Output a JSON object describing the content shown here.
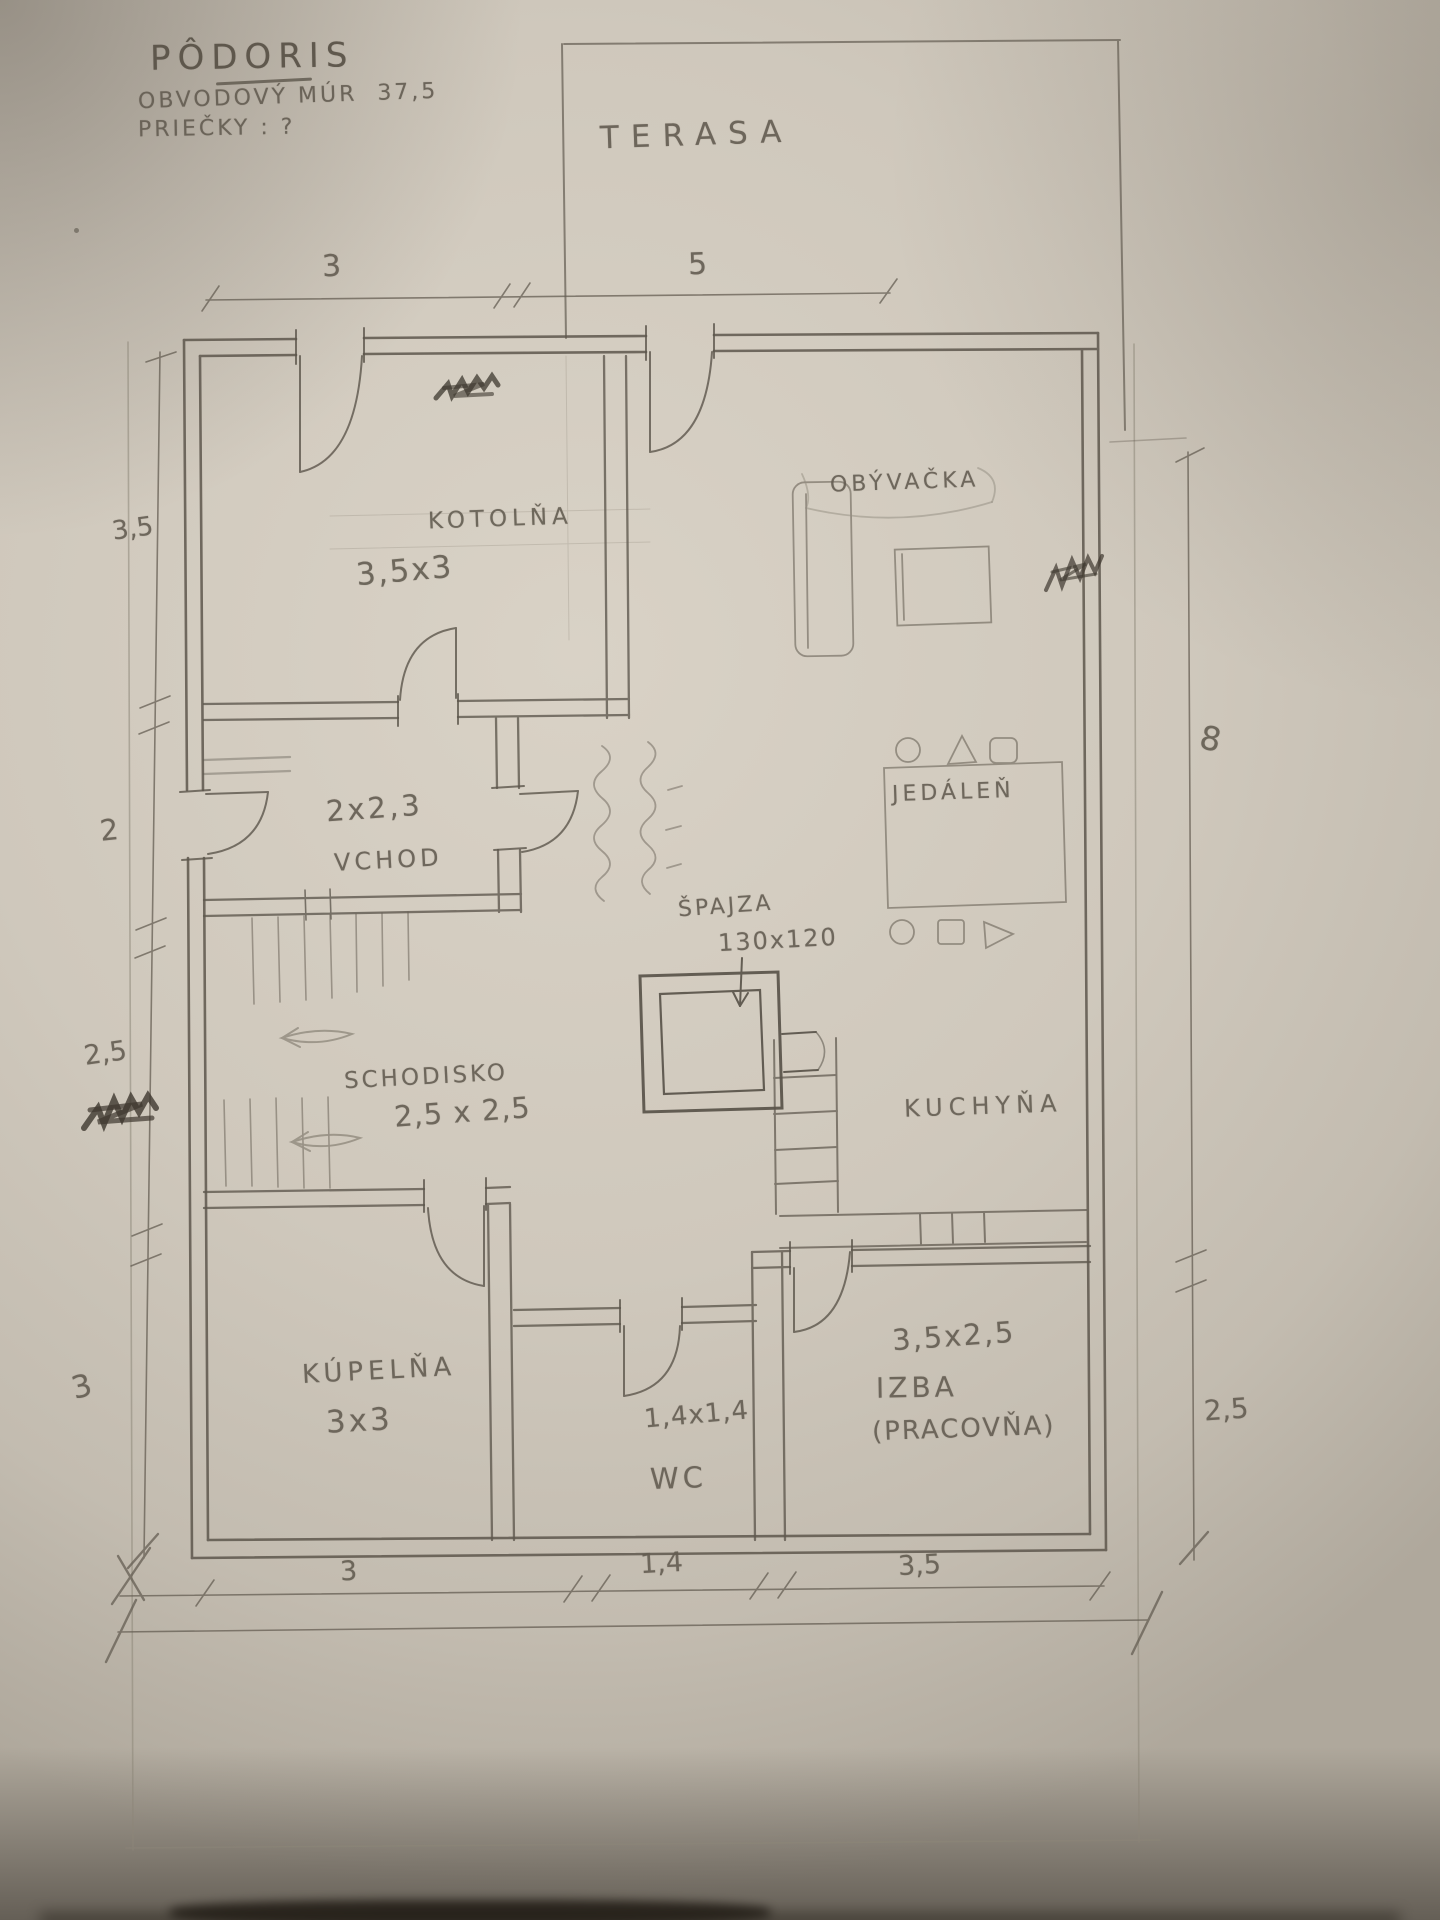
{
  "title": {
    "line1": "PÔDORIS",
    "line2": "OBVODOVÝ MÚR  37,5",
    "line3": "PRIEČKY : ?"
  },
  "terrace": {
    "label": "TERASA"
  },
  "rooms": {
    "kotolna": {
      "name": "KOTOLŇA",
      "size": "3,5x3"
    },
    "obyvacka": {
      "name": "OBÝVAČKA"
    },
    "vchod": {
      "name": "VCHOD",
      "size": "2x2,3"
    },
    "jedalen": {
      "name": "JEDÁLEŇ"
    },
    "spajza": {
      "name": "ŠPAJZA",
      "size": "130x120"
    },
    "kuchyna": {
      "name": "KUCHYŇA"
    },
    "schodisko": {
      "name": "SCHODISKO",
      "size": "2,5 x 2,5"
    },
    "kupelna": {
      "name": "KÚPELŇA",
      "size": "3x3"
    },
    "wc": {
      "name": "WC",
      "size": "1,4x1,4"
    },
    "izba": {
      "name": "IZBA",
      "name2": "(PRACOVŇA)",
      "size": "3,5x2,5"
    }
  },
  "dimensions": {
    "top": {
      "d1": "3",
      "d2": "5"
    },
    "left": {
      "d1": "3,5",
      "d2": "2",
      "d3": "2,5",
      "d4": "3"
    },
    "right": {
      "d1": "8",
      "d2": "2,5"
    },
    "bottom": {
      "d1": "3",
      "d2": "1,4",
      "d3": "3,5"
    }
  },
  "colors": {
    "paper": "#cfc8bc",
    "pencil": "#6a6358",
    "pencil_dark": "#554e44",
    "scribble": "#3e382f"
  }
}
